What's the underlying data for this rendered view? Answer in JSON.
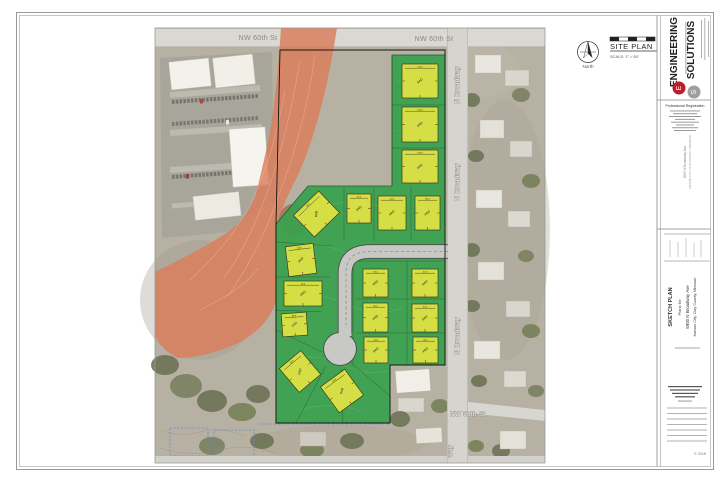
{
  "streets": {
    "nw60_a": "NW 60th St",
    "nw60_b": "NW 60th St",
    "broadway_a": "N Broadway",
    "broadway_b": "N Broadway",
    "broadway_c": "N Broadway",
    "broadway_partial": "way",
    "nw59": "NW 59th St"
  },
  "legend": {
    "site_plan": "SITE PLAN",
    "scale": "SCALE: 1\" = 60'",
    "north": "North"
  },
  "titleblock": {
    "logo1": "ENGINEERING",
    "logo2": "SOLUTIONS",
    "logo_e": "E",
    "logo_s": "S",
    "prof_reg": "Professional Registration",
    "addr1": "5900 N Broadway Ave",
    "addr2": "KANSAS CITY, CLAY COUNTY, MISSOURI",
    "project": {
      "title": "SKETCH PLAN",
      "plans_for": "Plans for:",
      "address": "5900 N Broadway Ave",
      "city": "Kansas City, Clay County, Missouri"
    },
    "copyright": "© 2018"
  },
  "map": {
    "colors": {
      "green_area": "#3aa14e",
      "pad_yellow": "#d5de44",
      "stream_corridor": "#db7c5a",
      "subdivision_road": "#c8c8c4",
      "aerial_base": "#b6b1a3"
    },
    "pads_note": "yellow building pads on sketch plan",
    "pads": [
      {
        "x": 299,
        "y": 199,
        "w": 35,
        "h": 30,
        "r": -44,
        "label": "PAD",
        "dim": "60.0"
      },
      {
        "x": 347,
        "y": 194,
        "w": 24,
        "h": 29,
        "r": 0,
        "label": "PAD",
        "dim": "60.0"
      },
      {
        "x": 378,
        "y": 196,
        "w": 28,
        "h": 34,
        "r": 0,
        "label": "PAD",
        "dim": "60.0"
      },
      {
        "x": 415,
        "y": 196,
        "w": 25,
        "h": 34,
        "r": 0,
        "label": "PAD",
        "dim": "60.0"
      },
      {
        "x": 402,
        "y": 64,
        "w": 36,
        "h": 34,
        "r": 0,
        "label": "PAD",
        "dim": "135.0"
      },
      {
        "x": 402,
        "y": 107,
        "w": 36,
        "h": 35,
        "r": 0,
        "label": "PAD",
        "dim": "135.0"
      },
      {
        "x": 402,
        "y": 150,
        "w": 36,
        "h": 33,
        "r": 0,
        "label": "PAD",
        "dim": "135.0"
      },
      {
        "x": 287,
        "y": 245,
        "w": 28,
        "h": 30,
        "r": -7,
        "label": "PAD",
        "dim": "60.0"
      },
      {
        "x": 284,
        "y": 281,
        "w": 38,
        "h": 25,
        "r": 0,
        "label": "PAD",
        "dim": "60.0"
      },
      {
        "x": 282,
        "y": 313,
        "w": 25,
        "h": 23,
        "r": -4,
        "label": "PAD",
        "dim": "60.0"
      },
      {
        "x": 286,
        "y": 356,
        "w": 28,
        "h": 31,
        "r": -40,
        "label": "PAD",
        "dim": "60.0"
      },
      {
        "x": 327,
        "y": 375,
        "w": 30,
        "h": 32,
        "r": -36,
        "label": "PAD",
        "dim": "60.0"
      },
      {
        "x": 363,
        "y": 269,
        "w": 25,
        "h": 28,
        "r": 0,
        "label": "PAD",
        "dim": "60.0"
      },
      {
        "x": 363,
        "y": 303,
        "w": 25,
        "h": 29,
        "r": 0,
        "label": "PAD",
        "dim": "60.0"
      },
      {
        "x": 364,
        "y": 337,
        "w": 24,
        "h": 26,
        "r": 0,
        "label": "PAD",
        "dim": "60.0"
      },
      {
        "x": 412,
        "y": 269,
        "w": 26,
        "h": 28,
        "r": 0,
        "label": "PAD",
        "dim": "60.0"
      },
      {
        "x": 412,
        "y": 304,
        "w": 26,
        "h": 28,
        "r": 0,
        "label": "PAD",
        "dim": "60.0"
      },
      {
        "x": 413,
        "y": 337,
        "w": 25,
        "h": 26,
        "r": 0,
        "label": "PAD",
        "dim": "60.0"
      }
    ]
  }
}
